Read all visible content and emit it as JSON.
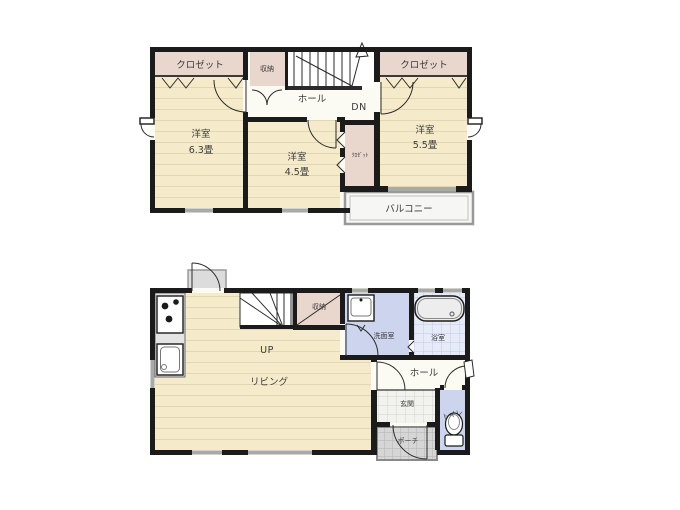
{
  "plan": {
    "floor2": {
      "closet_left": "クロゼット",
      "storage": "収納",
      "hall": "ホール",
      "dn": "DN",
      "closet_right": "クロゼット",
      "room_63_name": "洋室",
      "room_63_size": "6.3畳",
      "room_45_name": "洋室",
      "room_45_size": "4.5畳",
      "closet_mid": "ｸﾛｾﾞｯﾄ",
      "room_55_name": "洋室",
      "room_55_size": "5.5畳",
      "balcony": "バルコニー"
    },
    "floor1": {
      "storage": "収納",
      "up": "UP",
      "living": "リビング",
      "washroom": "洗面室",
      "bathroom": "浴室",
      "hall": "ホール",
      "entrance": "玄関",
      "porch": "ポーチ",
      "toilet": "トイレ"
    },
    "colors": {
      "wall": "#1b1b1b",
      "tatami_floor": "#f5ebcb",
      "closet": "#e9d6cc",
      "water_area": "#ccd4ee",
      "bath_tile": "#e6ebf7",
      "hall_floor": "#fbfaf3",
      "window": "#a9a9a9",
      "porch_tile": "#d6d6d6",
      "balcony": "#f6f6f4"
    }
  }
}
